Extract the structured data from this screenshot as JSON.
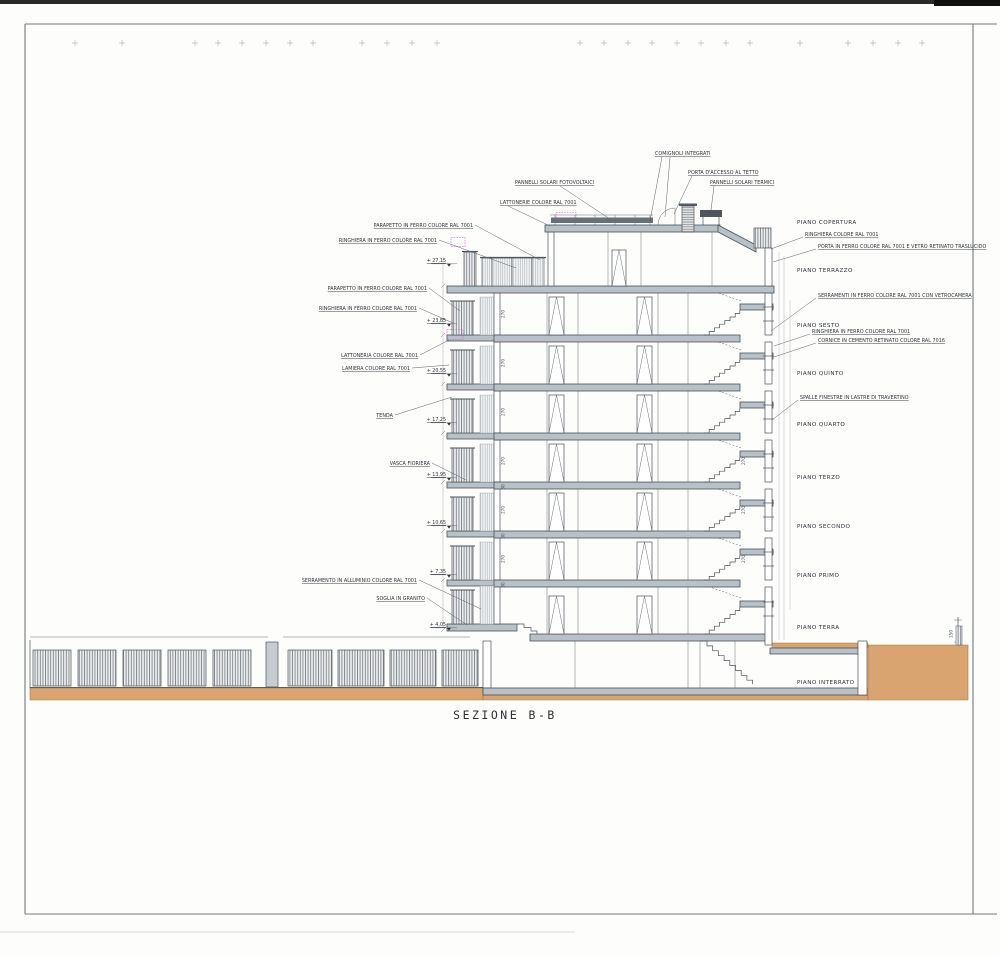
{
  "title": {
    "label": "SEZIONE B-B"
  },
  "floors": [
    {
      "label": "PIANO COPERTURA"
    },
    {
      "label": "PIANO TERRAZZO"
    },
    {
      "label": "PIANO SESTO"
    },
    {
      "label": "PIANO QUINTO"
    },
    {
      "label": "PIANO QUARTO"
    },
    {
      "label": "PIANO TERZO"
    },
    {
      "label": "PIANO SECONDO"
    },
    {
      "label": "PIANO PRIMO"
    },
    {
      "label": "PIANO TERRA"
    },
    {
      "label": "PIANO INTERRATO"
    }
  ],
  "annotations": {
    "left": [
      "PARAPETTO IN FERRO COLORE RAL 7001",
      "RINGHIERA IN FERRO COLORE RAL 7001",
      "PARAPETTO IN FERRO COLORE RAL 7001",
      "RINGHIERA IN FERRO COLORE RAL 7001",
      "LATTONERIA COLORE RAL 7001",
      "LAMIERA COLORE RAL 7001",
      "TENDA",
      "VASCA FIORIERA",
      "SERRAMENTO IN ALLUMINIO COLORE RAL 7001",
      "SOGLIA IN GRANITO"
    ],
    "top": [
      "COMIGNOLI INTEGRATI",
      "PORTA D'ACCESSO AL TETTO",
      "PANNELLI SOLARI TERMICI",
      "PANNELLI SOLARI FOTOVOLTAICI",
      "LATTONERIE COLORE RAL 7001"
    ],
    "right": [
      "RINGHIERA COLORE RAL 7001",
      "PORTA IN FERRO COLORE RAL 7001 E VETRO RETINATO TRASLUCIDO",
      "SERRAMENTI IN FERRO COLORE RAL 7001 CON VETROCAMERA",
      "RINGHIERA IN FERRO COLORE RAL 7001",
      "CORNICE IN CEMENTO RETINATO COLORE RAL 7016",
      "SPALLE FINESTRE IN LASTRE DI TRAVERTINO"
    ]
  },
  "elevations": [
    "+ 27,15",
    "+ 23,85",
    "+ 20,55",
    "+ 17,25",
    "+ 13,95",
    "+ 10,65",
    "+ 7,35",
    "+ 4,05"
  ],
  "dims": {
    "floor_height": "270",
    "slab": "30",
    "ground_marker": "150"
  },
  "colors": {
    "earth": "#D9A470",
    "slab": "#B9C1C8",
    "line": "#4A5258",
    "magenta": "#C24FC2"
  }
}
